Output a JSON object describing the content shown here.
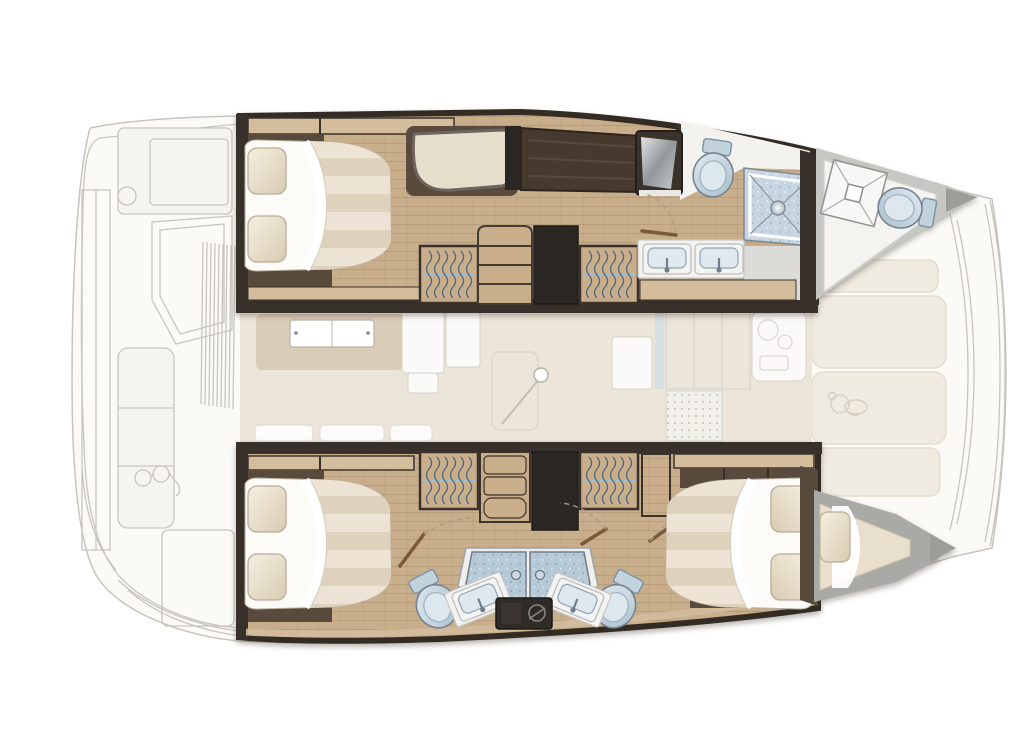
{
  "meta": {
    "title": "Catamaran interior layout plan",
    "description": "Top-down deck plan of a sailing catamaran, bow to the right: two hulls with cabins and bathrooms drawn in full colour, saloon, galley, aft cockpit and foredeck sunpads drawn as a faint ghost sketch.",
    "visible_text": []
  },
  "palette": {
    "wood": "#c9ae8c",
    "trim_tan": "#d3bd9d",
    "walnut": "#584b3e",
    "walnut_dark": "#46392d",
    "wall_dark": "#38302a",
    "charcoal": "#2b2724",
    "cushion": "#e7dfcc",
    "mattress": "#fcfbf8",
    "stripe_light": "#ece3d4",
    "stripe_dark": "#ded2bd",
    "pillow_light": "#f5efe1",
    "pillow_dark": "#d8ccb2",
    "ceramic_blue": "#b4c8d6",
    "ceramic_light": "#dce8ef",
    "shower_floor": "#c7d5e1",
    "shower_door": "#b5c9d6",
    "counter": "#f3f3f1",
    "deck_gray": "#c6c6c3",
    "deck_gray_dark": "#9c9c99",
    "sunpad": "#f0ebe1",
    "saloon_floor": "#ebe5da",
    "saloon_tan": "#d9cdb9",
    "ghost_fill": "#fbfaf7",
    "ghost_line": "#c8c5be",
    "outline_dark": "#332c25",
    "door_leaf": "#7a5a38",
    "door_swing": "#a89b89"
  },
  "plan": {
    "vessel_type": "catamaran",
    "view": "top-down floor plan",
    "bow_direction": "right",
    "upper_hull": {
      "rooms": [
        {
          "name": "aft cabin",
          "fixtures": [
            "double island berth",
            "two pillows",
            "chaise seat",
            "headboard joinery"
          ]
        },
        {
          "name": "companionway",
          "fixtures": [
            "staircase",
            "hanging locker",
            "hanging locker",
            "charcoal closet",
            "walnut desk"
          ]
        },
        {
          "name": "bathroom",
          "fixtures": [
            "shower cabinet",
            "toilet",
            "walk-in shower with drain",
            "twin sinks on counter",
            "door with swing arc"
          ]
        },
        {
          "name": "forepeak",
          "fixtures": [
            "deck hatch",
            "marine toilet"
          ]
        }
      ]
    },
    "lower_hull": {
      "rooms": [
        {
          "name": "aft cabin",
          "fixtures": [
            "double island berth",
            "two pillows",
            "hanging locker",
            "shelf unit",
            "door with swing arc"
          ]
        },
        {
          "name": "landing",
          "fixtures": [
            "staircase wall",
            "charcoal closet",
            "hanging locker",
            "two shower stalls",
            "two toilets",
            "two angled sinks",
            "dark vanity cabinet"
          ]
        },
        {
          "name": "forward cabin",
          "fixtures": [
            "double berth",
            "two pillows",
            "walnut lockers",
            "door with swing arc"
          ]
        },
        {
          "name": "bow berth",
          "fixtures": [
            "v-berth cushion",
            "pillow"
          ]
        }
      ]
    },
    "center_deck": {
      "rooms": [
        {
          "name": "saloon (ghosted)",
          "fixtures": [
            "lounge pad",
            "dining table",
            "cabinet block",
            "mast post",
            "skylight outline",
            "sofa backs"
          ]
        },
        {
          "name": "galley (ghosted)",
          "fixtures": [
            "door panel",
            "hinge strip",
            "cabinet run",
            "dotted drainer mat",
            "worktop with burner sketch"
          ]
        },
        {
          "name": "foredeck",
          "fixtures": [
            "sunpad cushion",
            "sunpad cushion",
            "sunpad cushion with teddy-bear sketch",
            "sunpad cushion",
            "anchor channel",
            "crossbeam arcs"
          ]
        },
        {
          "name": "aft cockpit (ghosted)",
          "fixtures": [
            "helm seat block",
            "winch circle",
            "console",
            "bench settee",
            "sunglasses sketch",
            "side louvres",
            "transom steps",
            "swim platform hatch"
          ]
        }
      ]
    }
  }
}
